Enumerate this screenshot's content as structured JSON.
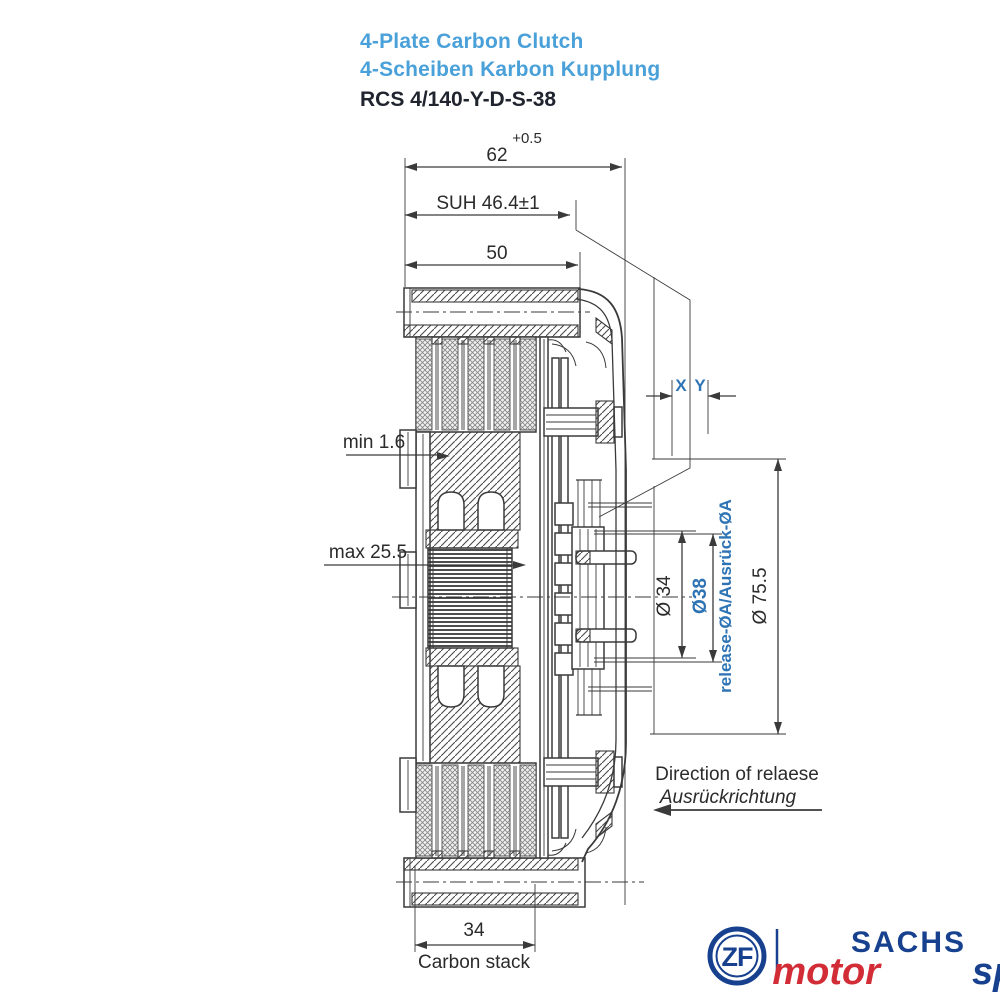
{
  "title": {
    "product_en": "4-Plate Carbon Clutch",
    "product_de": "4-Scheiben Karbon Kupplung",
    "model": "RCS 4/140-Y-D-S-38"
  },
  "dims": {
    "total_width": "62",
    "total_width_tol": "+0.5",
    "suh": "SUH 46.4±1",
    "cover_width": "50",
    "min_wear": "min 1.6",
    "max_travel": "max 25.5",
    "x_label": "X",
    "y_label": "Y",
    "dia_34": "Ø 34",
    "dia_38": "Ø38",
    "release_dia": "release-ØA/Ausrück-ØA",
    "dia_75_5": "Ø 75.5",
    "carbon_stack_width": "34",
    "carbon_stack_label": "Carbon stack",
    "direction_en": "Direction of relaese",
    "direction_de": "Ausrückrichtung"
  },
  "logo": {
    "zf": "ZF",
    "brand": "SACHS",
    "motor": "motor",
    "sport": "sport"
  },
  "colors": {
    "title_blue": "#4aa0d8",
    "annotation_blue": "#2e74b5",
    "drawing_line": "#3a3a3a",
    "logo_blue": "#17418e",
    "logo_red": "#d22d36"
  }
}
